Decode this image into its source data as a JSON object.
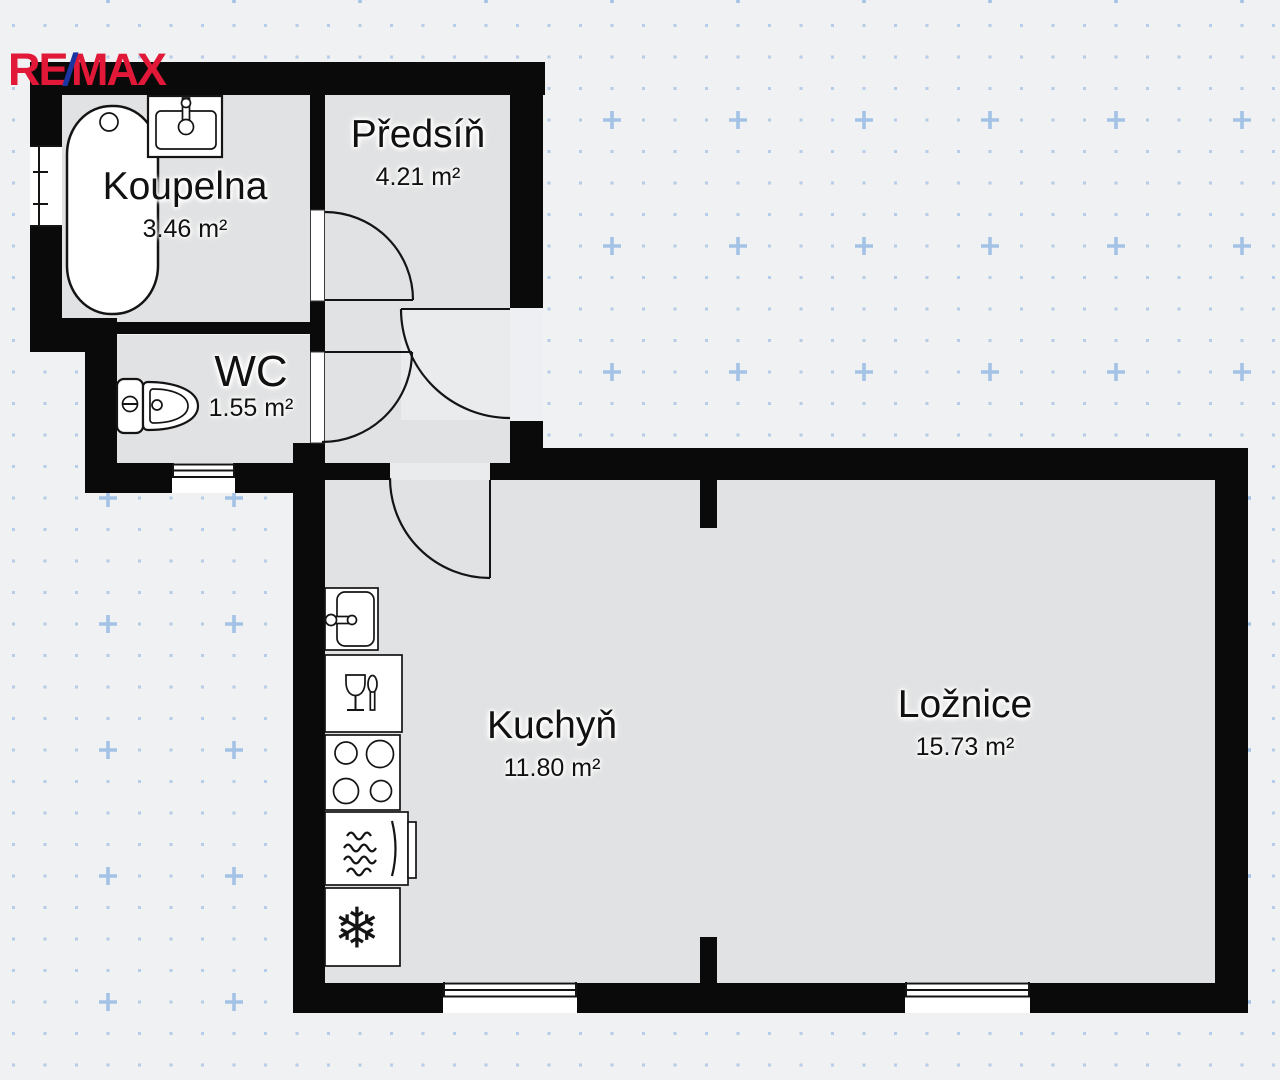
{
  "brand": {
    "re": "RE",
    "slash": "/",
    "max": "MAX",
    "name": "RE/MAX"
  },
  "rooms": [
    {
      "id": "koupelna",
      "name": "Koupelna",
      "area": "3.46 m²"
    },
    {
      "id": "predsin",
      "name": "Předsíň",
      "area": "4.21 m²"
    },
    {
      "id": "wc",
      "name": "WC",
      "area": "1.55 m²"
    },
    {
      "id": "kuchyn",
      "name": "Kuchyň",
      "area": "11.80 m²"
    },
    {
      "id": "loznice",
      "name": "Ložnice",
      "area": "15.73 m²"
    }
  ],
  "fixtures": [
    "bathtub",
    "washbasin",
    "toilet",
    "kitchen-sink",
    "dishwasher",
    "cooktop",
    "oven",
    "refrigerator"
  ],
  "icons": {
    "snowflake": "❄"
  },
  "colors": {
    "bg": "#eff1f3",
    "room_fill": "#e1e2e3",
    "room_fill_light": "#e9ebed",
    "entry_gap": "#edeff2",
    "wall": "#0a0a0a",
    "dot": "#b7cce7",
    "plus_marker": "#a3c2e5",
    "brand_red": "#e11837",
    "brand_blue": "#1d35a3"
  }
}
